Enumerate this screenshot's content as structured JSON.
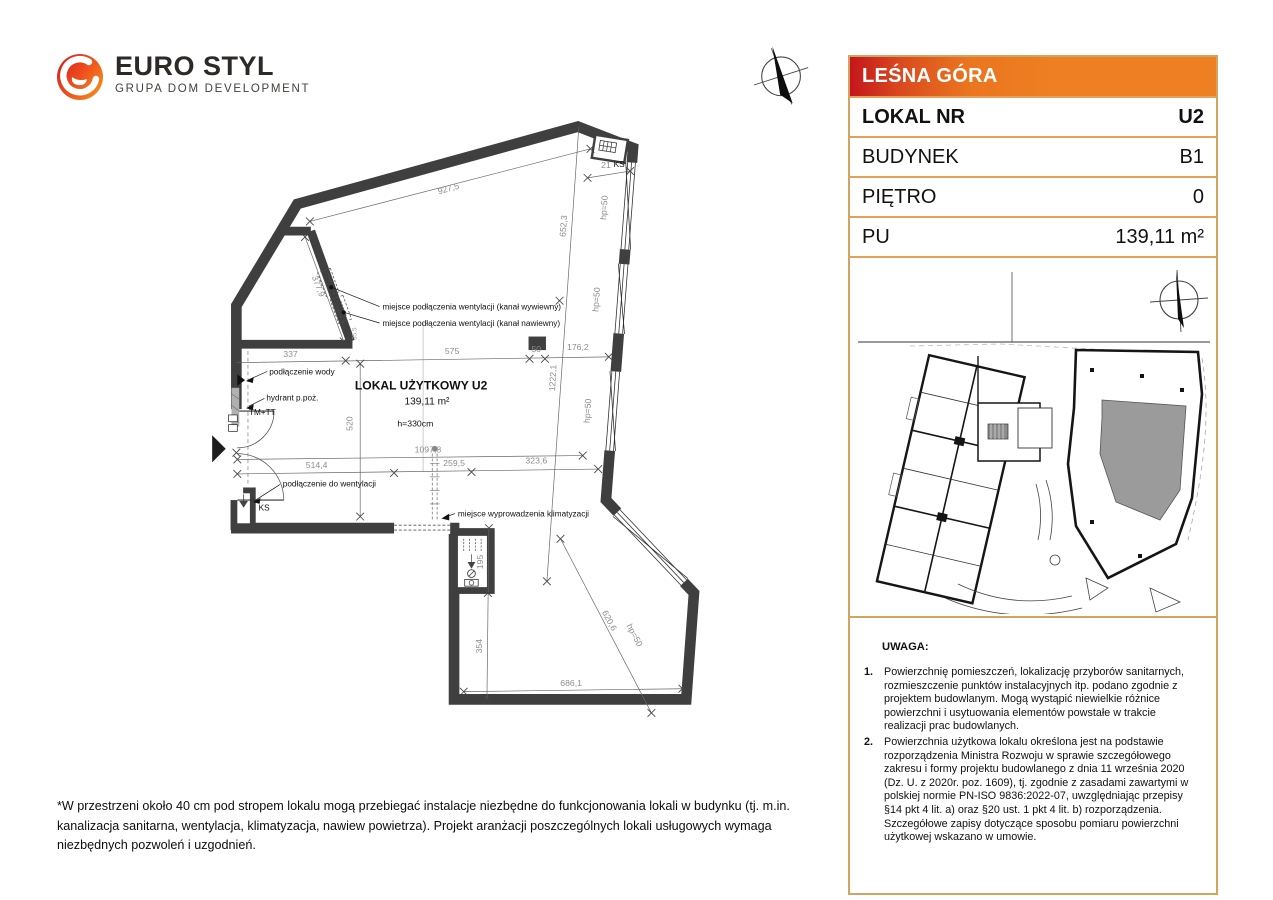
{
  "logo": {
    "brand_line1": "EURO STYL",
    "brand_line2": "GRUPA DOM DEVELOPMENT"
  },
  "info_panel": {
    "project_name": "LEŚNA GÓRA",
    "rows": [
      {
        "label": "LOKAL NR",
        "value": "U2"
      },
      {
        "label": "BUDYNEK",
        "value": "B1"
      },
      {
        "label": "PIĘTRO",
        "value": "0"
      },
      {
        "label": "PU",
        "value": "139,11 m²"
      }
    ],
    "colors": {
      "header_gradient_start": "#c4161c",
      "header_gradient_end": "#ee7f22",
      "border": "#d2a45f",
      "highlight_unit_fill": "#9b9b9b"
    }
  },
  "floor_plan": {
    "unit_title": "LOKAL UŻYTKOWY U2",
    "unit_area": "139,11 m²",
    "unit_height": "h=330cm",
    "dims": {
      "top": "927,5",
      "slant": "377,9",
      "right_upper": "652,3",
      "right_lower": "1222,1",
      "ks_offset": "21",
      "left_top": "337",
      "mid_top": "575",
      "pillar": "50",
      "right_top": "176,2",
      "left_height": "520",
      "small": "35,5",
      "interior_width": "1097,8",
      "left_bottom": "514,4",
      "mid_bottom": "259,5",
      "right_bottom": "323,6",
      "shaft_height": "195",
      "lower_height": "354",
      "bottom": "686,1",
      "diag": "620,6",
      "hp": "hp=50",
      "ks": "KS",
      "tm": "TM+TT"
    },
    "labels": {
      "vent_exhaust": "miejsce podłączenia wentylacji (kanał wywiewny)",
      "vent_supply": "miejsce podłączenia wentylacji (kanał nawiewny)",
      "water": "podłączenie wody",
      "hydrant": "hydrant p.poż.",
      "vent_connect": "podłączenie do wentylacji",
      "ac_outlet": "miejsce wyprowadzenia klimatyzacji"
    }
  },
  "notes": {
    "heading": "UWAGA:",
    "items": [
      {
        "num": "1.",
        "text": "Powierzchnię pomieszczeń, lokalizację przyborów sanitarnych, rozmieszczenie punktów instalacyjnych itp. podano zgodnie z projektem budowlanym. Mogą wystąpić niewielkie różnice powierzchni i usytuowania elementów powstałe w trakcie realizacji prac budowlanych."
      },
      {
        "num": "2.",
        "text": "Powierzchnia użytkowa lokalu określona jest na podstawie rozporządzenia Ministra Rozwoju w sprawie szczegółowego zakresu i formy projektu budowlanego z dnia 11 września 2020 (Dz. U. z 2020r. poz. 1609), tj. zgodnie z zasadami zawartymi w polskiej normie PN-ISO 9836:2022-07, uwzględniając przepisy §14 pkt 4 lit. a) oraz §20 ust. 1 pkt 4 lit. b) rozporządzenia. Szczegółowe zapisy dotyczące sposobu pomiaru powierzchni użytkowej wskazano w umowie."
      }
    ]
  },
  "footnote": "*W przestrzeni około 40 cm pod stropem lokalu mogą przebiegać instalacje niezbędne do funkcjonowania lokali w budynku (tj. m.in. kanalizacja sanitarna, wentylacja, klimatyzacja, nawiew powietrza). Projekt aranżacji poszczególnych lokali usługowych wymaga niezbędnych pozwoleń i uzgodnień."
}
